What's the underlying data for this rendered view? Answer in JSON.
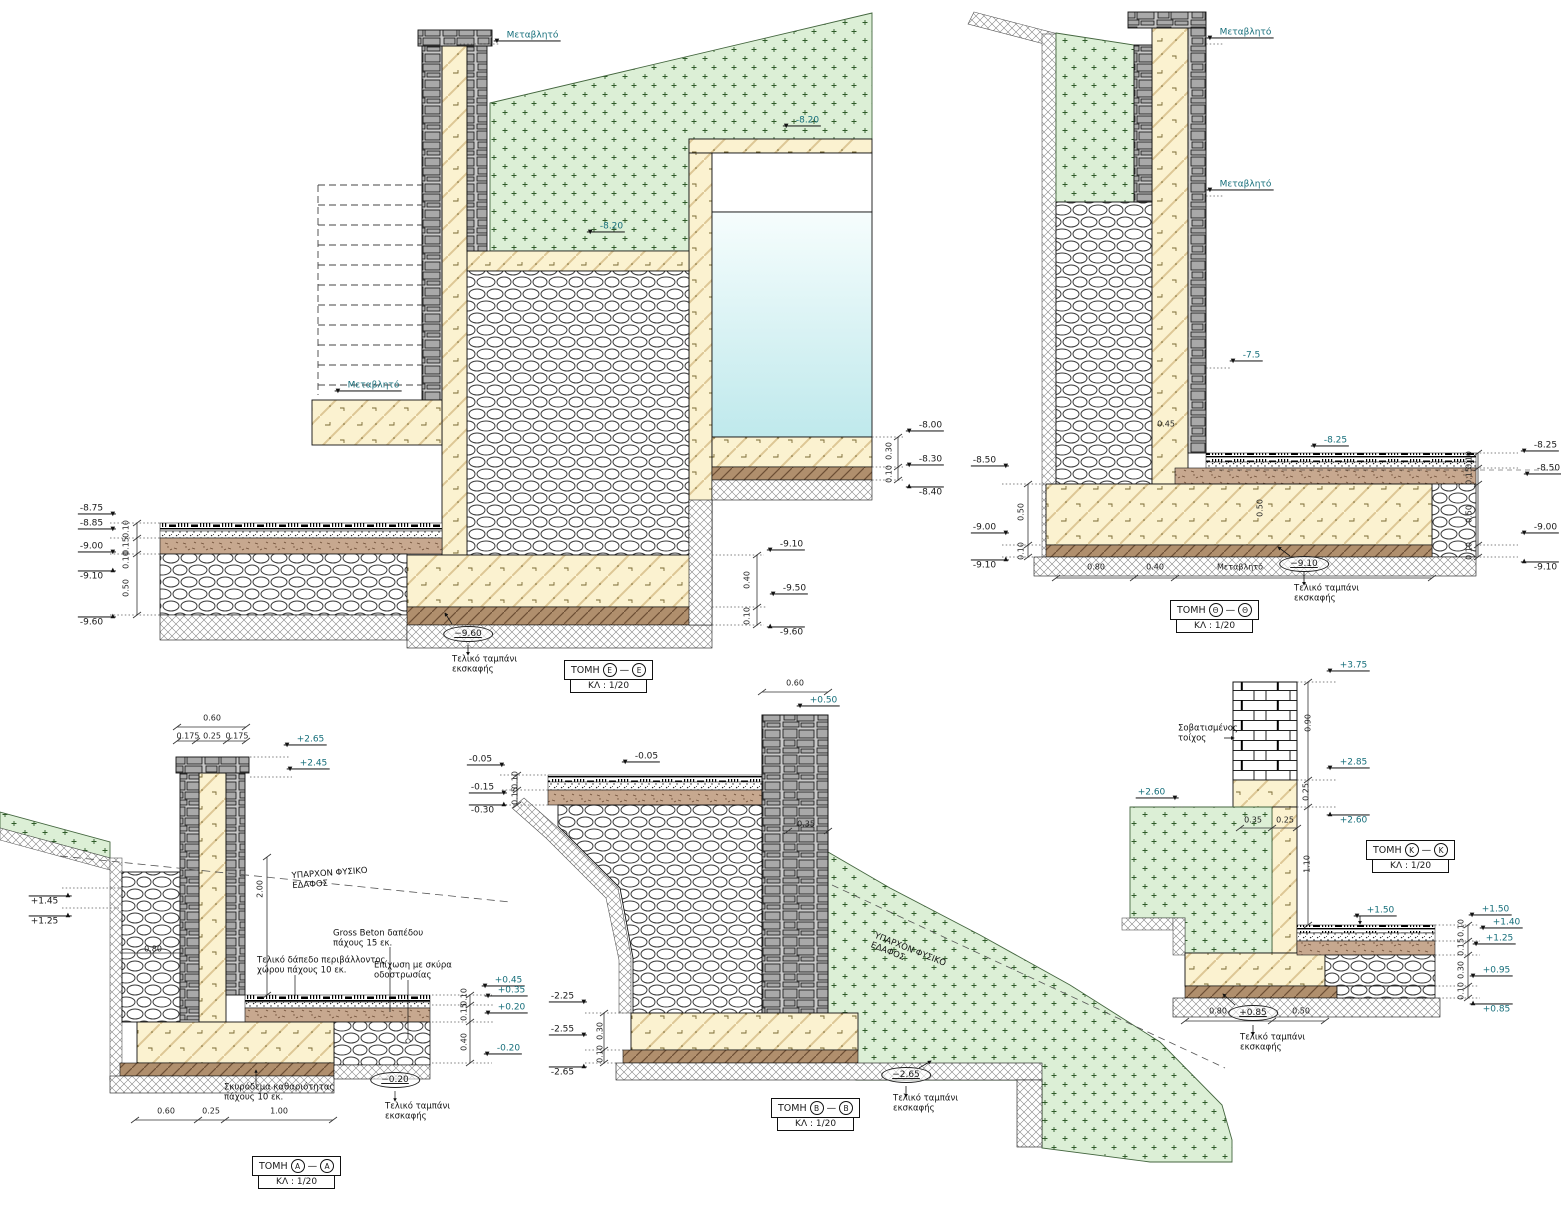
{
  "palette": {
    "teal": "#176f7b",
    "ink": "#1a1a1a",
    "green_fill": "#dcefd6",
    "concrete": "#fbf2d0",
    "water": "#bfe9ec",
    "stone": "#a9a9a9"
  },
  "sections": [
    {
      "id": "ee",
      "word": "ΤΟΜΗ",
      "letter": "Ε",
      "dash": "—",
      "scale": "ΚΛ : 1/20",
      "x": 564,
      "y": 660
    },
    {
      "id": "th",
      "word": "ΤΟΜΗ",
      "letter": "Θ",
      "dash": "—",
      "scale": "ΚΛ : 1/20",
      "x": 1170,
      "y": 600
    },
    {
      "id": "aa",
      "word": "ΤΟΜΗ",
      "letter": "Α",
      "dash": "—",
      "scale": "ΚΛ : 1/20",
      "x": 252,
      "y": 1156
    },
    {
      "id": "bb",
      "word": "ΤΟΜΗ",
      "letter": "Β",
      "dash": "—",
      "scale": "ΚΛ : 1/20",
      "x": 771,
      "y": 1098
    },
    {
      "id": "kk",
      "word": "ΤΟΜΗ",
      "letter": "Κ",
      "dash": "—",
      "scale": "ΚΛ : 1/20",
      "x": 1366,
      "y": 840
    }
  ],
  "ellipse_markers": [
    {
      "s": "ee",
      "t": "−9.60",
      "x": 468,
      "y": 634
    },
    {
      "s": "th",
      "t": "−9.10",
      "x": 1304,
      "y": 564
    },
    {
      "s": "aa",
      "t": "−0.20",
      "x": 395,
      "y": 1080
    },
    {
      "s": "bb",
      "t": "−2.65",
      "x": 906,
      "y": 1075
    },
    {
      "s": "kk",
      "t": "+0.85",
      "x": 1253,
      "y": 1013
    }
  ],
  "labels": [
    {
      "s": "ee",
      "t": "Μεταβλητό",
      "x": 527,
      "y": 36,
      "k": "elev",
      "c": "teal",
      "f": "dl"
    },
    {
      "s": "ee",
      "t": "-8.20",
      "x": 802,
      "y": 121,
      "k": "elev",
      "c": "teal",
      "f": "dl"
    },
    {
      "s": "ee",
      "t": "-8.20",
      "x": 606,
      "y": 227,
      "k": "elev",
      "c": "teal",
      "f": "dl"
    },
    {
      "s": "ee",
      "t": "Μεταβλητό",
      "x": 368,
      "y": 386,
      "k": "elev",
      "c": "teal",
      "f": "dl"
    },
    {
      "s": "ee",
      "t": "-8.75",
      "x": 97,
      "y": 509,
      "k": "elev",
      "f": "dr"
    },
    {
      "s": "ee",
      "t": "-8.85",
      "x": 97,
      "y": 524,
      "k": "elev",
      "f": "dr"
    },
    {
      "s": "ee",
      "t": "-9.00",
      "x": 97,
      "y": 547,
      "k": "elev",
      "f": "dr"
    },
    {
      "s": "ee",
      "t": "-9.10",
      "x": 97,
      "y": 576,
      "k": "elev",
      "f": "ur"
    },
    {
      "s": "ee",
      "t": "-9.60",
      "x": 97,
      "y": 622,
      "k": "elev",
      "f": "ur"
    },
    {
      "s": "ee",
      "t": "0.10",
      "x": 127,
      "y": 529,
      "k": "dim",
      "r": -90
    },
    {
      "s": "ee",
      "t": "0.15",
      "x": 127,
      "y": 546,
      "k": "dim",
      "r": -90
    },
    {
      "s": "ee",
      "t": "0.10",
      "x": 127,
      "y": 560,
      "k": "dim",
      "r": -90
    },
    {
      "s": "ee",
      "t": "0.50",
      "x": 127,
      "y": 588,
      "k": "dim",
      "r": -90
    },
    {
      "s": "ee",
      "t": "-8.00",
      "x": 925,
      "y": 426,
      "k": "elev",
      "f": "dl"
    },
    {
      "s": "ee",
      "t": "0.30",
      "x": 890,
      "y": 451,
      "k": "dim",
      "r": -90
    },
    {
      "s": "ee",
      "t": "-8.30",
      "x": 925,
      "y": 460,
      "k": "elev",
      "f": "dl"
    },
    {
      "s": "ee",
      "t": "0.10",
      "x": 890,
      "y": 474,
      "k": "dim",
      "r": -90
    },
    {
      "s": "ee",
      "t": "-8.40",
      "x": 925,
      "y": 492,
      "k": "elev",
      "f": "ul"
    },
    {
      "s": "ee",
      "t": "-9.10",
      "x": 786,
      "y": 545,
      "k": "elev",
      "f": "dl"
    },
    {
      "s": "ee",
      "t": "0.40",
      "x": 748,
      "y": 580,
      "k": "dim",
      "r": -90
    },
    {
      "s": "ee",
      "t": "-9.50",
      "x": 789,
      "y": 589,
      "k": "elev",
      "f": "dl"
    },
    {
      "s": "ee",
      "t": "0.10",
      "x": 748,
      "y": 616,
      "k": "dim",
      "r": -90
    },
    {
      "s": "ee",
      "t": "-9.60",
      "x": 786,
      "y": 632,
      "k": "elev",
      "f": "ul"
    },
    {
      "s": "ee",
      "t": "Τελικό ταμπάνι\nεκσκαφής",
      "x": 452,
      "y": 665,
      "k": "note",
      "a": "l"
    },
    {
      "s": "th",
      "t": "Μεταβλητό",
      "x": 1240,
      "y": 33,
      "k": "elev",
      "c": "teal",
      "f": "dl"
    },
    {
      "s": "th",
      "t": "Μεταβλητό",
      "x": 1240,
      "y": 185,
      "k": "elev",
      "c": "teal",
      "f": "dl"
    },
    {
      "s": "th",
      "t": "-7.5",
      "x": 1246,
      "y": 356,
      "k": "elev",
      "c": "teal",
      "f": "dl"
    },
    {
      "s": "th",
      "t": "-8.25",
      "x": 1330,
      "y": 441,
      "k": "elev",
      "c": "teal",
      "f": "dl"
    },
    {
      "s": "th",
      "t": "0.45",
      "x": 1166,
      "y": 425,
      "k": "dim"
    },
    {
      "s": "th",
      "t": "0.50",
      "x": 1261,
      "y": 508,
      "k": "dim",
      "r": -90
    },
    {
      "s": "th",
      "t": "-8.50",
      "x": 990,
      "y": 461,
      "k": "elev",
      "f": "dr"
    },
    {
      "s": "th",
      "t": "0.50",
      "x": 1022,
      "y": 512,
      "k": "dim",
      "r": -90
    },
    {
      "s": "th",
      "t": "-9.00",
      "x": 990,
      "y": 528,
      "k": "elev",
      "f": "dr"
    },
    {
      "s": "th",
      "t": "0.10",
      "x": 1022,
      "y": 551,
      "k": "dim",
      "r": -90
    },
    {
      "s": "th",
      "t": "-9.10",
      "x": 990,
      "y": 565,
      "k": "elev",
      "f": "ur"
    },
    {
      "s": "th",
      "t": "-8.25",
      "x": 1540,
      "y": 446,
      "k": "elev",
      "f": "dl"
    },
    {
      "s": "th",
      "t": "0.10",
      "x": 1470,
      "y": 460,
      "k": "dim",
      "r": -90
    },
    {
      "s": "th",
      "t": "-8.50",
      "x": 1543,
      "y": 469,
      "k": "elev",
      "f": "dl"
    },
    {
      "s": "th",
      "t": "0.15",
      "x": 1470,
      "y": 476,
      "k": "dim",
      "r": -90
    },
    {
      "s": "th",
      "t": "0.50",
      "x": 1470,
      "y": 514,
      "k": "dim",
      "r": -90
    },
    {
      "s": "th",
      "t": "-9.00",
      "x": 1540,
      "y": 528,
      "k": "elev",
      "f": "dl"
    },
    {
      "s": "th",
      "t": "0.10",
      "x": 1470,
      "y": 551,
      "k": "dim",
      "r": -90
    },
    {
      "s": "th",
      "t": "-9.10",
      "x": 1540,
      "y": 567,
      "k": "elev",
      "f": "ul"
    },
    {
      "s": "th",
      "t": "0.80",
      "x": 1096,
      "y": 568,
      "k": "dim"
    },
    {
      "s": "th",
      "t": "0.40",
      "x": 1155,
      "y": 568,
      "k": "dim"
    },
    {
      "s": "th",
      "t": "Μεταβλητό",
      "x": 1240,
      "y": 568,
      "k": "dim"
    },
    {
      "s": "th",
      "t": "Τελικό ταμπάνι\nεκσκαφής",
      "x": 1294,
      "y": 594,
      "k": "note",
      "a": "l"
    },
    {
      "s": "aa",
      "t": "0.60",
      "x": 212,
      "y": 719,
      "k": "dim"
    },
    {
      "s": "aa",
      "t": "0.175",
      "x": 188,
      "y": 737,
      "k": "dim"
    },
    {
      "s": "aa",
      "t": "0.25",
      "x": 212,
      "y": 737,
      "k": "dim"
    },
    {
      "s": "aa",
      "t": "0.175",
      "x": 237,
      "y": 737,
      "k": "dim"
    },
    {
      "s": "aa",
      "t": "+2.65",
      "x": 305,
      "y": 740,
      "k": "elev",
      "c": "teal",
      "f": "dl"
    },
    {
      "s": "aa",
      "t": "+2.45",
      "x": 308,
      "y": 764,
      "k": "elev",
      "c": "teal",
      "f": "dl"
    },
    {
      "s": "aa",
      "t": "ΥΠΑΡΧΟΝ ΦΥΣΙΚΟ\nΕΔΑΦΟΣ",
      "x": 330,
      "y": 879,
      "k": "note",
      "r": -4
    },
    {
      "s": "aa",
      "t": "+1.45",
      "x": 50,
      "y": 901,
      "k": "elev",
      "f": "ur"
    },
    {
      "s": "aa",
      "t": "+1.25",
      "x": 50,
      "y": 921,
      "k": "elev",
      "f": "ur"
    },
    {
      "s": "aa",
      "t": "0.80",
      "x": 153,
      "y": 950,
      "k": "dim"
    },
    {
      "s": "aa",
      "t": "2.00",
      "x": 261,
      "y": 889,
      "k": "dim",
      "r": -90
    },
    {
      "s": "aa",
      "t": "Gross Beton δαπέδου\nπάχους 15 εκ.",
      "x": 333,
      "y": 939,
      "k": "note",
      "a": "l"
    },
    {
      "s": "aa",
      "t": "Τελικό δάπεδο περιβάλλοντος\nχώρου πάχους 10 εκ.",
      "x": 257,
      "y": 966,
      "k": "note",
      "a": "l"
    },
    {
      "s": "aa",
      "t": "Επίχωση με σκύρα\nοδοστρωσίας",
      "x": 374,
      "y": 971,
      "k": "note",
      "a": "l"
    },
    {
      "s": "aa",
      "t": "+0.45",
      "x": 503,
      "y": 981,
      "k": "elev",
      "c": "teal",
      "f": "dl"
    },
    {
      "s": "aa",
      "t": "0.10",
      "x": 465,
      "y": 997,
      "k": "dim",
      "r": -90
    },
    {
      "s": "aa",
      "t": "+0.35",
      "x": 506,
      "y": 991,
      "k": "elev",
      "c": "teal",
      "f": "dl"
    },
    {
      "s": "aa",
      "t": "0.15",
      "x": 465,
      "y": 1012,
      "k": "dim",
      "r": -90
    },
    {
      "s": "aa",
      "t": "+0.20",
      "x": 506,
      "y": 1008,
      "k": "elev",
      "c": "teal",
      "f": "dl"
    },
    {
      "s": "aa",
      "t": "0.40",
      "x": 465,
      "y": 1042,
      "k": "dim",
      "r": -90
    },
    {
      "s": "aa",
      "t": "-0.20",
      "x": 503,
      "y": 1049,
      "k": "elev",
      "c": "teal",
      "f": "dl"
    },
    {
      "s": "aa",
      "t": "Σκυρόδεμα καθαριότητας\nπάχους 10 εκ.",
      "x": 224,
      "y": 1093,
      "k": "note",
      "a": "l"
    },
    {
      "s": "aa",
      "t": "Τελικό ταμπάνι\nεκσκαφής",
      "x": 385,
      "y": 1112,
      "k": "note",
      "a": "l"
    },
    {
      "s": "aa",
      "t": "0.60",
      "x": 166,
      "y": 1112,
      "k": "dim"
    },
    {
      "s": "aa",
      "t": "0.25",
      "x": 211,
      "y": 1112,
      "k": "dim"
    },
    {
      "s": "aa",
      "t": "1.00",
      "x": 279,
      "y": 1112,
      "k": "dim"
    },
    {
      "s": "bb",
      "t": "0.60",
      "x": 795,
      "y": 684,
      "k": "dim"
    },
    {
      "s": "bb",
      "t": "+0.50",
      "x": 818,
      "y": 701,
      "k": "elev",
      "c": "teal",
      "f": "dl"
    },
    {
      "s": "bb",
      "t": "-0.05",
      "x": 486,
      "y": 760,
      "k": "elev",
      "f": "dr"
    },
    {
      "s": "bb",
      "t": "-0.05",
      "x": 641,
      "y": 757,
      "k": "elev",
      "f": "dl"
    },
    {
      "s": "bb",
      "t": "0.10",
      "x": 516,
      "y": 780,
      "k": "dim",
      "r": -90
    },
    {
      "s": "bb",
      "t": "-0.15",
      "x": 488,
      "y": 788,
      "k": "elev",
      "f": "dr"
    },
    {
      "s": "bb",
      "t": "0.15",
      "x": 516,
      "y": 796,
      "k": "dim",
      "r": -90
    },
    {
      "s": "bb",
      "t": "-0.30",
      "x": 488,
      "y": 810,
      "k": "elev",
      "f": "ur"
    },
    {
      "s": "bb",
      "t": "0.35",
      "x": 806,
      "y": 825,
      "k": "dim"
    },
    {
      "s": "bb",
      "t": "ΥΠΑΡΧΟΝ ΦΥΣΙΚΟ\nΕΔΑΦΟΣ",
      "x": 908,
      "y": 955,
      "k": "note",
      "r": 22
    },
    {
      "s": "bb",
      "t": "-2.25",
      "x": 568,
      "y": 997,
      "k": "elev",
      "f": "dr"
    },
    {
      "s": "bb",
      "t": "0.30",
      "x": 601,
      "y": 1031,
      "k": "dim",
      "r": -90
    },
    {
      "s": "bb",
      "t": "-2.55",
      "x": 568,
      "y": 1030,
      "k": "elev",
      "f": "dr"
    },
    {
      "s": "bb",
      "t": "0.10",
      "x": 601,
      "y": 1054,
      "k": "dim",
      "r": -90
    },
    {
      "s": "bb",
      "t": "-2.65",
      "x": 568,
      "y": 1072,
      "k": "elev",
      "f": "ur"
    },
    {
      "s": "bb",
      "t": "Τελικό ταμπάνι\nεκσκαφής",
      "x": 893,
      "y": 1104,
      "k": "note",
      "a": "l"
    },
    {
      "s": "kk",
      "t": "+3.75",
      "x": 1348,
      "y": 666,
      "k": "elev",
      "c": "teal",
      "f": "dl"
    },
    {
      "s": "kk",
      "t": "Σοβατισμένος\nτοίχος",
      "x": 1178,
      "y": 734,
      "k": "note",
      "a": "l"
    },
    {
      "s": "kk",
      "t": "0.90",
      "x": 1309,
      "y": 723,
      "k": "dim",
      "r": -90
    },
    {
      "s": "kk",
      "t": "+2.85",
      "x": 1348,
      "y": 763,
      "k": "elev",
      "c": "teal",
      "f": "dl"
    },
    {
      "s": "kk",
      "t": "0.25",
      "x": 1307,
      "y": 792,
      "k": "dim",
      "r": -90
    },
    {
      "s": "kk",
      "t": "+2.60",
      "x": 1157,
      "y": 793,
      "k": "elev",
      "c": "teal",
      "f": "dr"
    },
    {
      "s": "kk",
      "t": "+2.60",
      "x": 1348,
      "y": 820,
      "k": "elev",
      "c": "teal",
      "f": "ul"
    },
    {
      "s": "kk",
      "t": "0.35",
      "x": 1253,
      "y": 821,
      "k": "dim"
    },
    {
      "s": "kk",
      "t": "0.25",
      "x": 1285,
      "y": 821,
      "k": "dim"
    },
    {
      "s": "kk",
      "t": "1.10",
      "x": 1308,
      "y": 864,
      "k": "dim",
      "r": -90
    },
    {
      "s": "kk",
      "t": "+1.50",
      "x": 1375,
      "y": 911,
      "k": "elev",
      "c": "teal",
      "f": "dl"
    },
    {
      "s": "kk",
      "t": "+1.50",
      "x": 1490,
      "y": 910,
      "k": "elev",
      "c": "teal",
      "f": "dl"
    },
    {
      "s": "kk",
      "t": "0.10",
      "x": 1462,
      "y": 928,
      "k": "dim",
      "r": -90
    },
    {
      "s": "kk",
      "t": "+1.40",
      "x": 1501,
      "y": 923,
      "k": "elev",
      "c": "teal",
      "f": "dl"
    },
    {
      "s": "kk",
      "t": "0.15",
      "x": 1462,
      "y": 947,
      "k": "dim",
      "r": -90
    },
    {
      "s": "kk",
      "t": "+1.25",
      "x": 1494,
      "y": 939,
      "k": "elev",
      "c": "teal",
      "f": "dl"
    },
    {
      "s": "kk",
      "t": "0.30",
      "x": 1462,
      "y": 970,
      "k": "dim",
      "r": -90
    },
    {
      "s": "kk",
      "t": "+0.95",
      "x": 1491,
      "y": 971,
      "k": "elev",
      "c": "teal",
      "f": "dl"
    },
    {
      "s": "kk",
      "t": "0.10",
      "x": 1462,
      "y": 991,
      "k": "dim",
      "r": -90
    },
    {
      "s": "kk",
      "t": "+0.85",
      "x": 1491,
      "y": 1009,
      "k": "elev",
      "c": "teal",
      "f": "ul"
    },
    {
      "s": "kk",
      "t": "0.80",
      "x": 1218,
      "y": 1012,
      "k": "dim"
    },
    {
      "s": "kk",
      "t": "0.50",
      "x": 1301,
      "y": 1012,
      "k": "dim"
    },
    {
      "s": "kk",
      "t": "Τελικό ταμπάνι\nεκσκαφής",
      "x": 1240,
      "y": 1043,
      "k": "note",
      "a": "l"
    }
  ]
}
